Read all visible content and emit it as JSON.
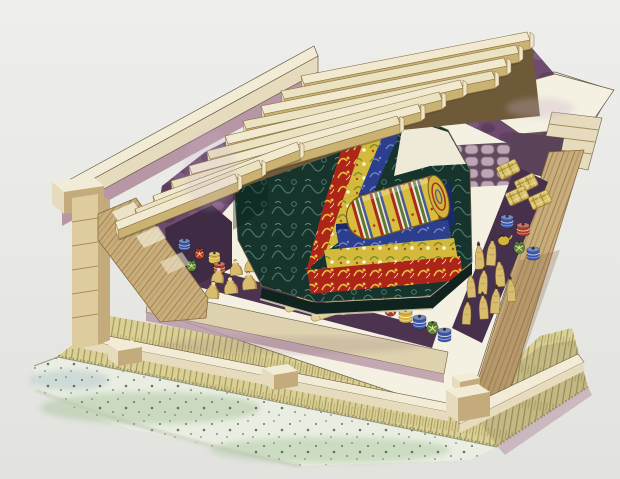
{
  "scene": {
    "description": "Watercolor cutaway illustration of an ancient timber burial chamber: partially removed roof beams reveal nested lacquered coffins (black, red, yellow and blue) around a silk-wrapped body bundle; surrounding compartments hold seated and standing figurines, painted pottery jars, woven baskets and silk rolls; the chamber rests on a bamboo-mat platform over a speckled clay-and-charcoal foundation, packed in dark purple clay fill.",
    "style": "hand-painted watercolor cutaway, no text labels"
  },
  "palette": {
    "bg_top": "#eeeeec",
    "bg_bottom": "#e2e2de",
    "ink": "#6b5c46",
    "cream": "#f2ecd6",
    "cream_dk": "#e6dbbd",
    "cream_face": "#ddd1ae",
    "white_top": "#f4f0e2",
    "beam_top": "#f1ead0",
    "beam_top2": "#ebe2c2",
    "beam_front": "#c9b272",
    "beam_line": "#8a7444",
    "beam_under": "#6e5a38",
    "mauve": "#b796a6",
    "wood_mid": "#c9ad7a",
    "wood_line": "#96774a",
    "wood_dark": "#8a6a44",
    "post": "#decb9e",
    "post_side": "#c3ab7c",
    "post_line": "#a98f62",
    "mat_base": "#d9d095",
    "mat_line": "#a2925a",
    "mat_shadow": "#5f5336",
    "found": "#eaeee2",
    "found_wash": "#aec9a4",
    "speck": "#55664e",
    "found_line": "#8a9a7c",
    "purple_mid": "#6d4a6e",
    "purple_dk": "#48304b",
    "purple_lt": "#9c7ba0",
    "lavender": "#c9aecb",
    "cobble_cell": "#b9a2b2",
    "cobble_line": "#7d6478",
    "inner_dark": "#5a4258",
    "compartment_s": "#4c3350",
    "compartment_e": "#47304c",
    "pocket_w": "#3f2b44",
    "coffin_dark": "#16332c",
    "coffin_teal": "#47756a",
    "coffin_red": "#ad2419",
    "orn_gold": "#e6c141",
    "coffin_yellow": "#d3ba3a",
    "orn_olive": "#7c8a2c",
    "coffin_blue": "#2c3f8e",
    "orn_ltblue": "#7886c8",
    "blue_deep": "#1a2a66",
    "bundle_yellow": "#d8be3c",
    "bundle_red": "#a82a1a",
    "bundle_green": "#5d7a32",
    "bundle_blue": "#4a5a92",
    "bundle_line": "#7a5a20",
    "robe": "#d9bd6e",
    "robe_shade": "#b2904a",
    "robe_line": "#8a6c34",
    "skin": "#ead9b2",
    "hair": "#3c332c",
    "roll": "#e3d096",
    "roll_line": "#a8914f",
    "basket": "#d8c268",
    "basket_line": "#a8872f",
    "jar_blue": "#3a56a8",
    "jar_red": "#ab3a26",
    "jar_green": "#5a8a3a",
    "jar_yellow": "#d4b23c"
  },
  "counts": {
    "roof_beams": 11,
    "coffin_layers": 4,
    "body_bundle": 1,
    "seated_figurines": 14,
    "standing_figurines": 10,
    "silk_rolls": 7,
    "woven_baskets": 4,
    "jars_south": 5,
    "jars_east": 5,
    "pots_west": 5,
    "floor_blocks": 3
  },
  "coffin_layer_colors": [
    "black-green lacquer",
    "red lacquer",
    "yellow lacquer",
    "blue lacquer"
  ]
}
